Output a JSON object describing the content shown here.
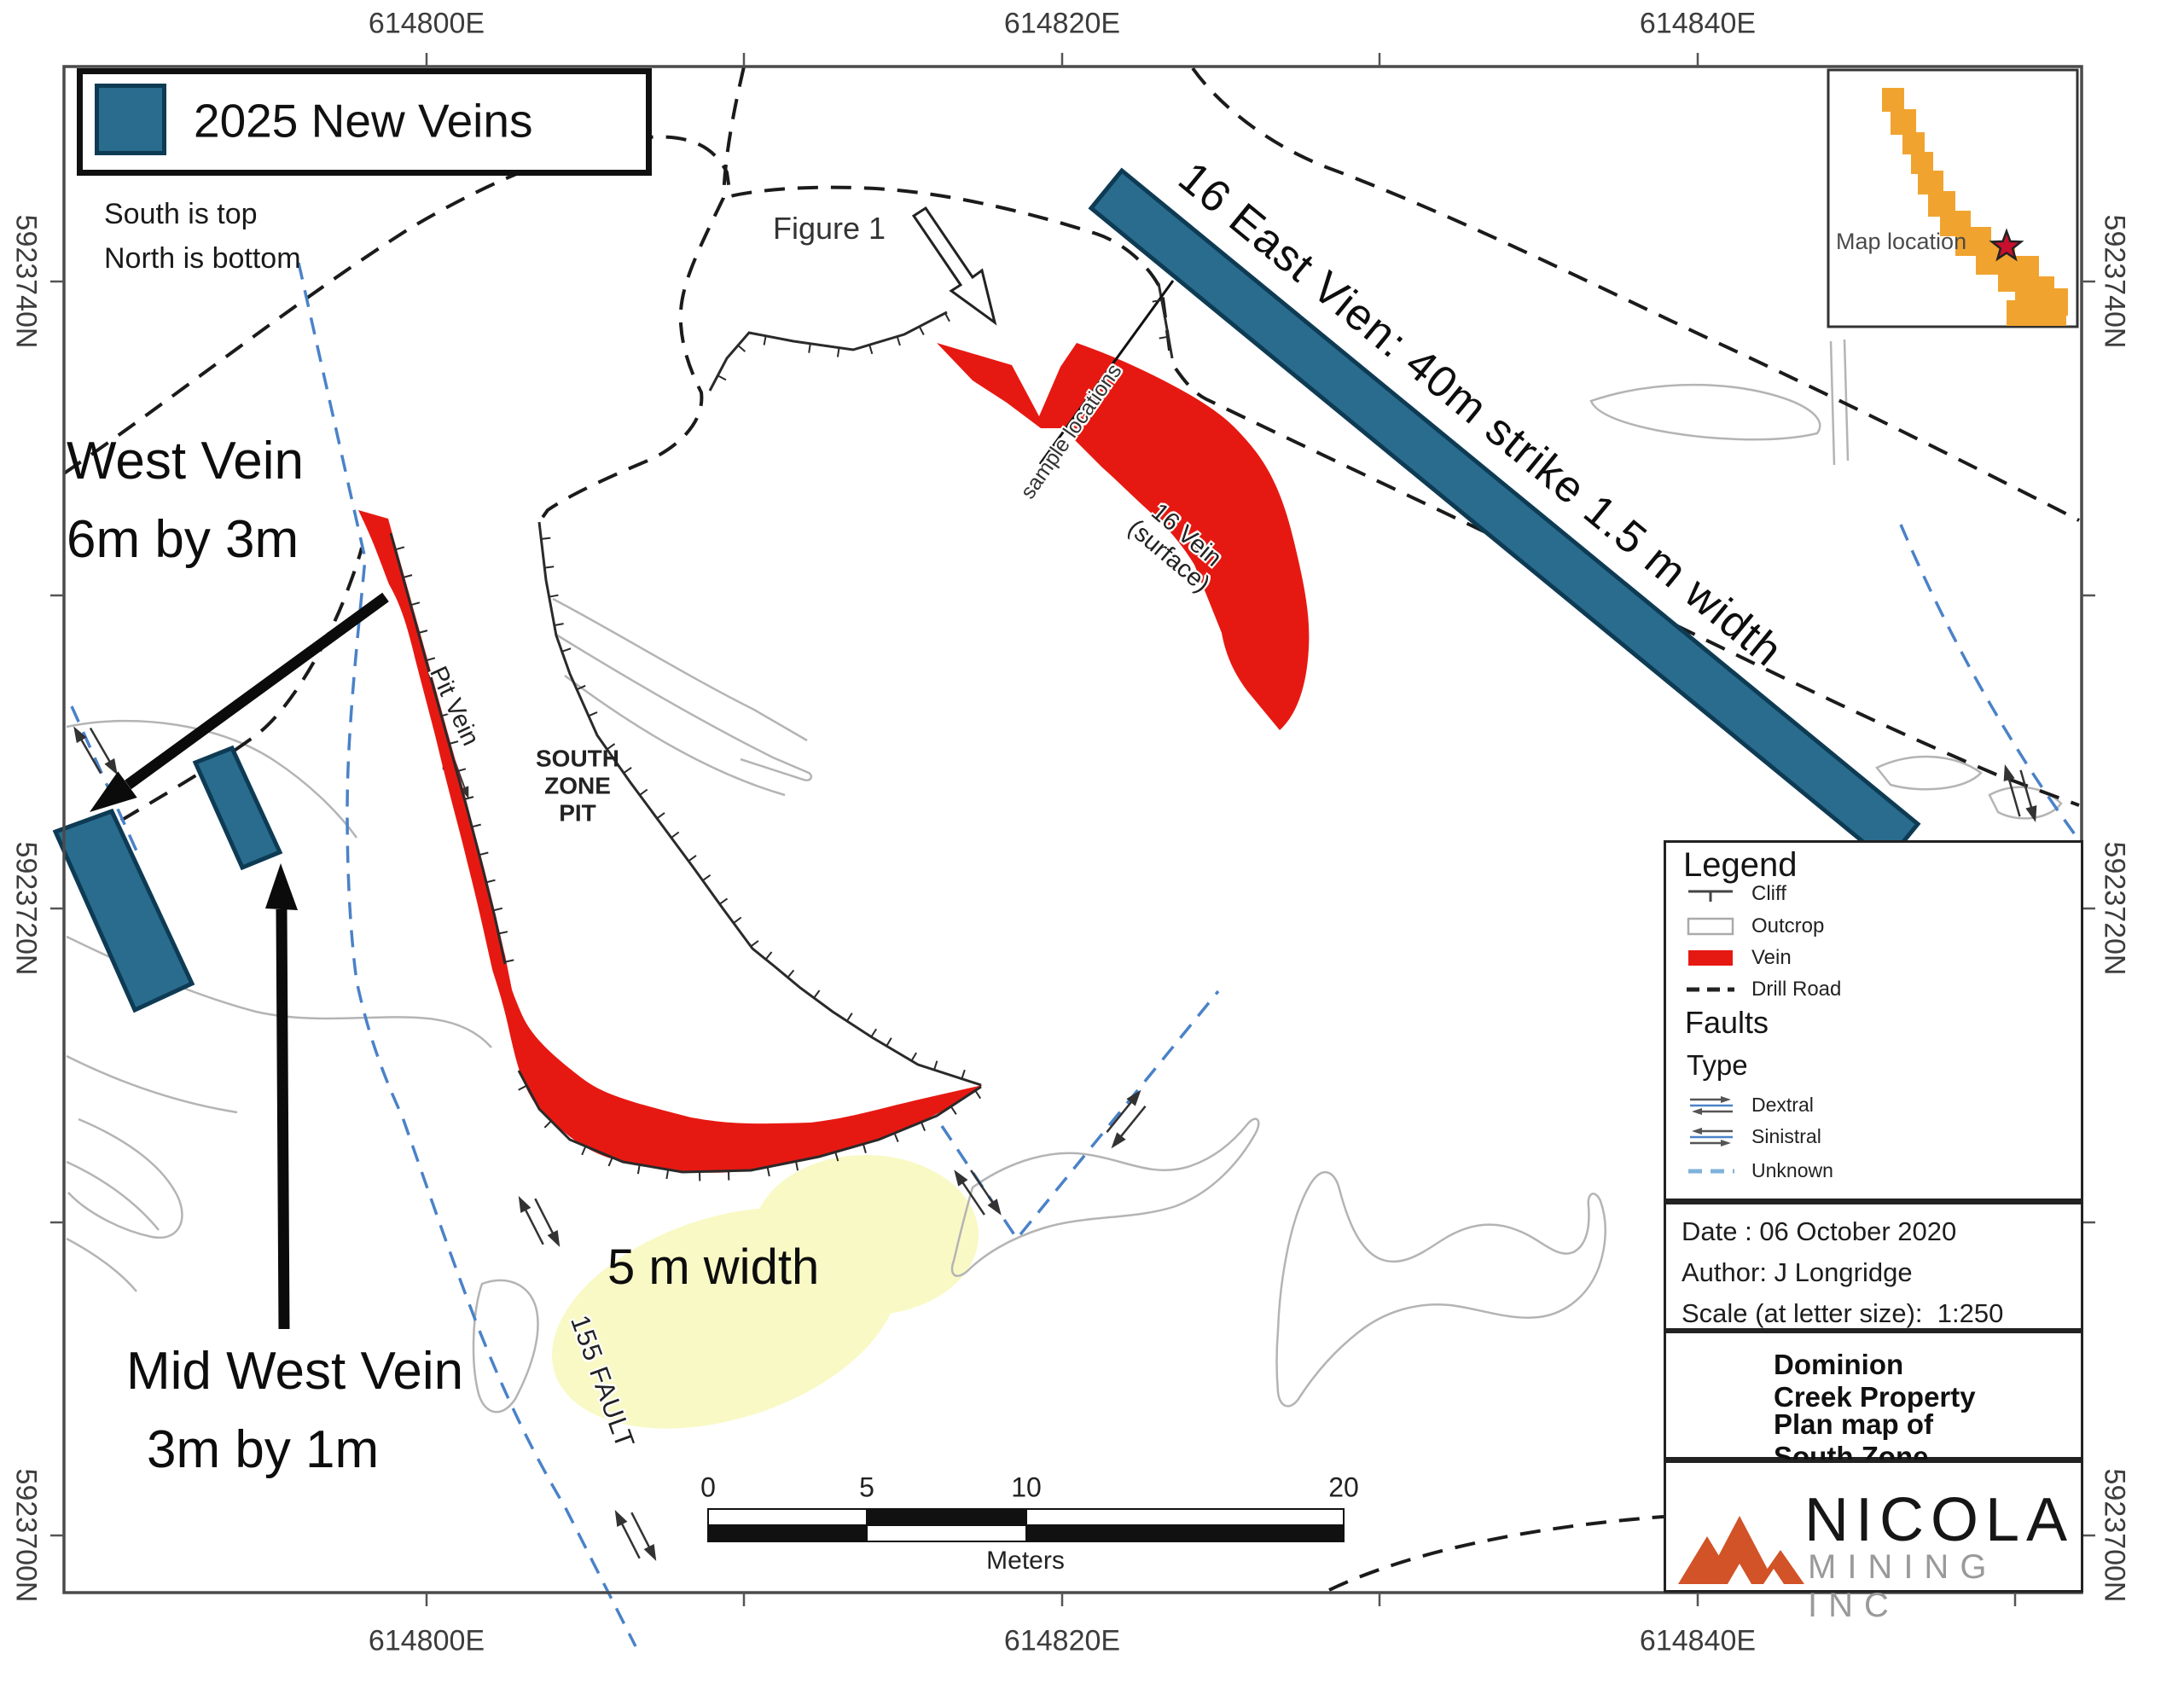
{
  "header": {
    "new_veins_label": "2025 New Veins",
    "orientation_line1": "South is top",
    "orientation_line2": "North is bottom"
  },
  "coordinates": {
    "top": [
      "614800E",
      "614820E",
      "614840E"
    ],
    "bottom": [
      "614800E",
      "614820E",
      "614840E"
    ],
    "left": [
      "5923740N",
      "5923720N",
      "5923700N"
    ],
    "right": [
      "5923740N",
      "5923720N",
      "5923700N"
    ]
  },
  "annotations": {
    "west_vein_line1": "West Vein",
    "west_vein_line2": "6m by 3m",
    "mid_west_vein_line1": "Mid West Vein",
    "mid_west_vein_line2": "3m by 1m",
    "east_vein_16": "16 East Vien:  40m strike 1.5 m width",
    "five_m_width": "5 m width",
    "fault_155": "155 FAULT",
    "pit_vein": "Pit Vein",
    "south_zone_pit_line1": "SOUTH",
    "south_zone_pit_line2": "ZONE",
    "south_zone_pit_line3": "PIT",
    "sample_locations": "sample locations",
    "vein_16_line1": "16 Vein",
    "vein_16_line2": "(surface)",
    "figure_1": "Figure 1"
  },
  "scale_bar": {
    "tick_0": "0",
    "tick_5": "5",
    "tick_10": "10",
    "tick_20": "20",
    "unit": "Meters"
  },
  "inset": {
    "label": "Map location"
  },
  "legend": {
    "title": "Legend",
    "items": [
      "Cliff",
      "Outcrop",
      "Vein",
      "Drill Road"
    ],
    "faults_heading": "Faults",
    "type_heading": "Type",
    "fault_types": [
      "Dextral",
      "Sinistral",
      "Unknown"
    ]
  },
  "info": {
    "date": "Date : 06 October 2020",
    "author": "Author: J Longridge",
    "scale": "Scale (at letter size):  1:250"
  },
  "titles": {
    "property": "Dominion Creek Property",
    "map_title": "Plan map of South Zone"
  },
  "logo": {
    "name": "NICOLA",
    "subtitle": "MINING INC"
  },
  "colors": {
    "new_vein_teal": "#2A6C8E",
    "teal_border": "#0E3B54",
    "vein_red": "#E61912",
    "highlight_yellow": "#F9F9C6",
    "inset_orange": "#F0A42F",
    "fault_blue": "#4A82C8",
    "outcrop_gray": "#B4B4B4",
    "road_black": "#1B1B1B",
    "logo_orange": "#D15327",
    "star_red": "#C8102E"
  }
}
